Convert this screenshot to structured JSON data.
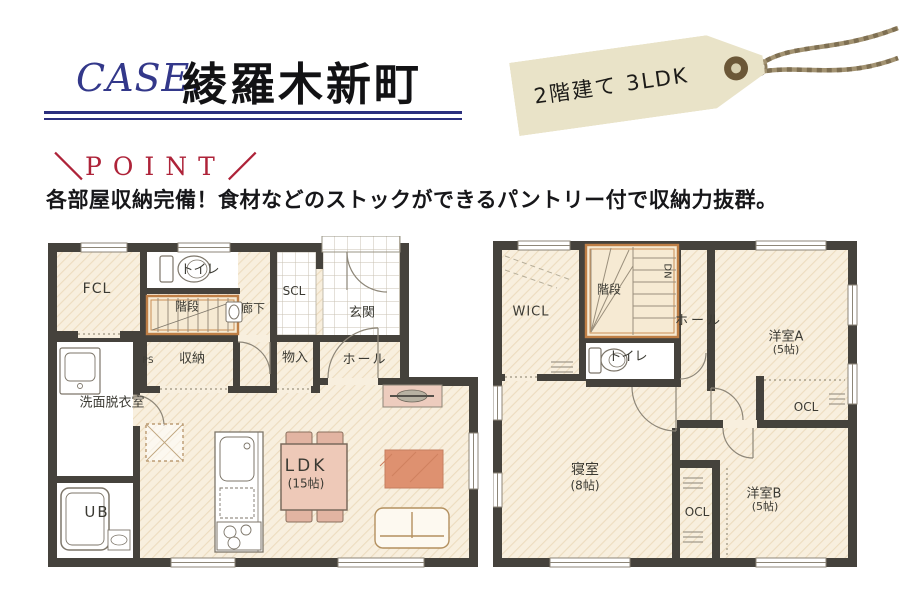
{
  "header": {
    "case_label": "CASE.",
    "title": "綾羅木新町"
  },
  "tag": {
    "label": "2階建て 3LDK"
  },
  "point": {
    "left_slash": "＼",
    "label": "POINT",
    "right_slash": "／"
  },
  "description": "各部屋収納完備！食材などのストックができるパントリー付で収納力抜群。",
  "colors": {
    "accent_navy": "#2b2f7e",
    "accent_red": "#ae2339",
    "tag_bg": "#e9e3c8",
    "tag_eyelet": "#6b5737",
    "twine": "#8d7d5c",
    "floor_beige": "#f8efde",
    "floor_hatch": "#eddcbf",
    "wall_dark": "#45423c",
    "stair_orange": "#bf7f46",
    "rug_orange": "#de9170",
    "table_pink": "#eec9b8"
  },
  "floorplan_1f": {
    "rooms": {
      "fcl": "FCL",
      "toilet": "トイレ",
      "stairs": "階段",
      "hallway": "廊下",
      "scl": "SCL",
      "genkan": "玄関",
      "ps": "PS",
      "storage": "収納",
      "monoire": "物入",
      "hall": "ホール",
      "washroom": "洗面脱衣室",
      "ub": "UB",
      "ldk_name": "LDK",
      "ldk_size": "(15帖)"
    }
  },
  "floorplan_2f": {
    "rooms": {
      "wicl": "WICL",
      "stairs": "階段",
      "dn": "DN",
      "hall": "ホール",
      "toilet": "トイレ",
      "room_a_name": "洋室A",
      "room_a_size": "(5帖)",
      "ocl_a": "OCL",
      "bedroom_name": "寝室",
      "bedroom_size": "(8帖)",
      "ocl_b": "OCL",
      "room_b_name": "洋室B",
      "room_b_size": "(5帖)"
    }
  }
}
